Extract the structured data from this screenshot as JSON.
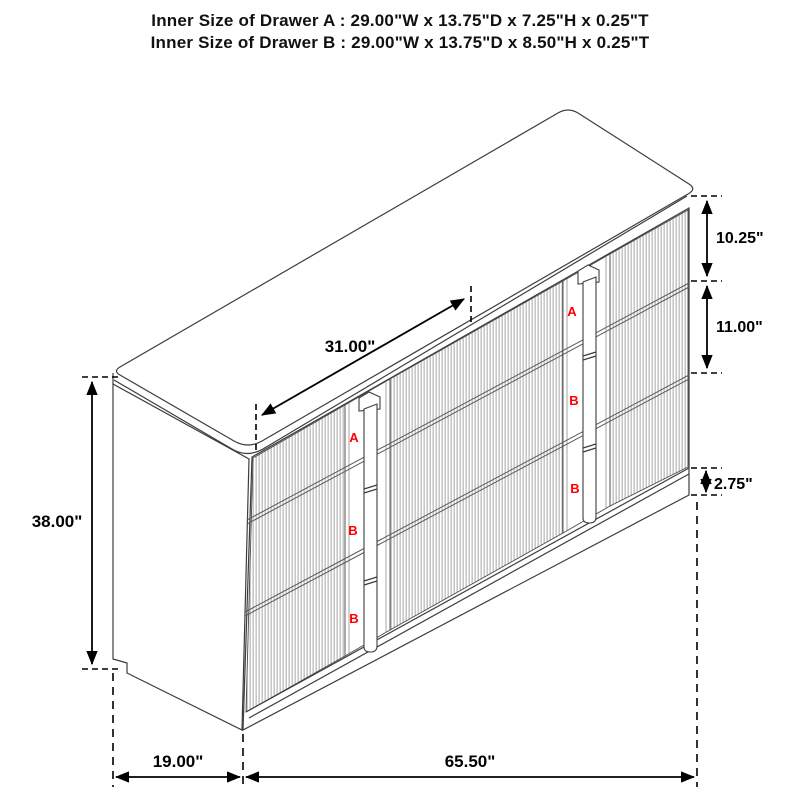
{
  "title": {
    "line1": "Inner Size of Drawer A : 29.00\"W x 13.75\"D x 7.25\"H x 0.25\"T",
    "line2": "Inner Size of Drawer B : 29.00\"W x 13.75\"D x 8.50\"H x 0.25\"T"
  },
  "dimensions": {
    "top_diagonal_width": "31.00\"",
    "overall_height": "38.00\"",
    "drawer_a_height": "10.25\"",
    "drawer_b_height": "11.00\"",
    "base_height": "2.75\"",
    "depth": "19.00\"",
    "overall_width": "65.50\""
  },
  "drawer_labels": {
    "left_stack": [
      "A",
      "B",
      "B"
    ],
    "right_stack": [
      "A",
      "B",
      "B"
    ]
  },
  "colors": {
    "drawer_label": "#ff0000",
    "dimension_lines": "#000000",
    "drawing_outline": "#3d3d3d",
    "background": "#ffffff"
  }
}
